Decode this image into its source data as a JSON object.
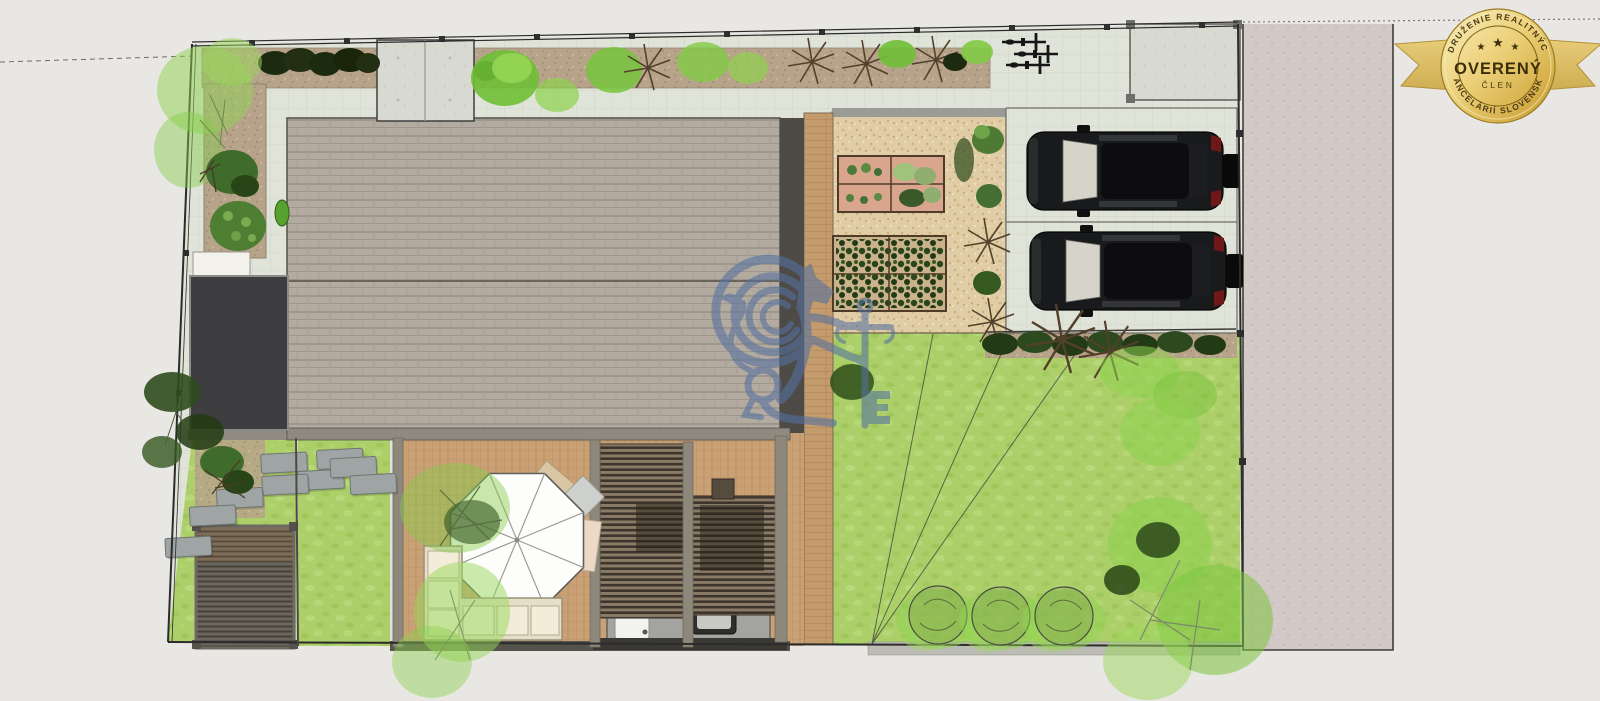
{
  "page": {
    "type": "real-estate listing rendering",
    "description": "Top-down 3D architectural site plan of a residential plot with house, pergola terrace, gravel garden, parking with two cars and lawn"
  },
  "badge": {
    "top_arc": "ZDRUŽENIE REALITNÝCH",
    "bottom_arc": "KANCELÁRIÍ SLOVENSKA",
    "main": "OVERENÝ",
    "sub": "ČLEN",
    "star": "★",
    "colors": {
      "gold_light": "#f9efbd",
      "gold_dark": "#c39a35",
      "text": "#3a2d0a",
      "ribbon": "#dcbd63"
    }
  },
  "watermark": {
    "icon": "lion-with-key-icon",
    "color": "#5471a1",
    "opacity": 0.58
  },
  "palette": {
    "background": "#e9e7e3",
    "pavers": "#dfe3d8",
    "roof": "#b3aaa0",
    "roof_edge": "#4e4b47",
    "garage_roof": "#3e3e40",
    "terrace_wood": "#c9a175",
    "gravel": "#e0cda6",
    "lawn": "#accf69",
    "sidewalk": "#d2c8c5",
    "hedge_dark": "#1c2a10",
    "tree_green": "#8ed14f",
    "car_body": "#191a1c",
    "umbrella": "#fdfdfc",
    "sofa": "#f2ecd8"
  },
  "regions": {
    "house_roof": "gabled shingle roof",
    "garage_roof": "dark flat roof",
    "terrace": "wooden terrace with pergola",
    "umbrella": "white parasol",
    "outdoor_kitchen": "sink and grill counter",
    "gravel_garden": "raised vegetable beds",
    "parking": "two parking stalls with SUVs",
    "bike_rack": "bicycles",
    "lawn": "irrigated lawn",
    "sidewalk": "public sidewalk"
  }
}
